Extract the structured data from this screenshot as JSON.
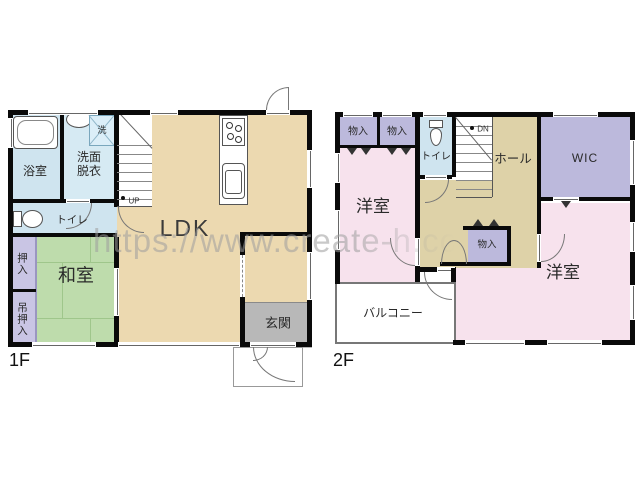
{
  "watermark": "https://www.create-h.co",
  "floor1": {
    "floor_label": "1F",
    "bath": "浴室",
    "washroom_line1": "洗面",
    "washroom_line2": "脱衣",
    "laundry": "洗",
    "toilet": "トイレ",
    "stairs_up": "UP",
    "ldk": "LDK",
    "closet": "押入",
    "hanging_closet": "吊押入",
    "japanese_room": "和室",
    "entrance": "玄関"
  },
  "floor2": {
    "floor_label": "2F",
    "storage1": "物入",
    "storage2": "物入",
    "toilet": "トイレ",
    "stairs_down": "DN",
    "hall": "ホール",
    "wic": "WIC",
    "bedroom_left": "洋室",
    "storage3": "物入",
    "balcony": "バルコニー",
    "bedroom_right": "洋室"
  },
  "colors": {
    "wall": "#0a0a0a",
    "ldk_tan": "#ecd9b0",
    "hall_tan": "#ded2a8",
    "bath_blue": "#cfe4ef",
    "washroom_blue": "#d6eaf3",
    "tatami_green": "#bedcac",
    "closet_purple": "#c9c5e4",
    "storage_purple": "#bcb9dc",
    "bedroom_pink": "#f7e2ed",
    "genkan_gray": "#b8b8b8",
    "watermark": "#9e9e9e"
  }
}
